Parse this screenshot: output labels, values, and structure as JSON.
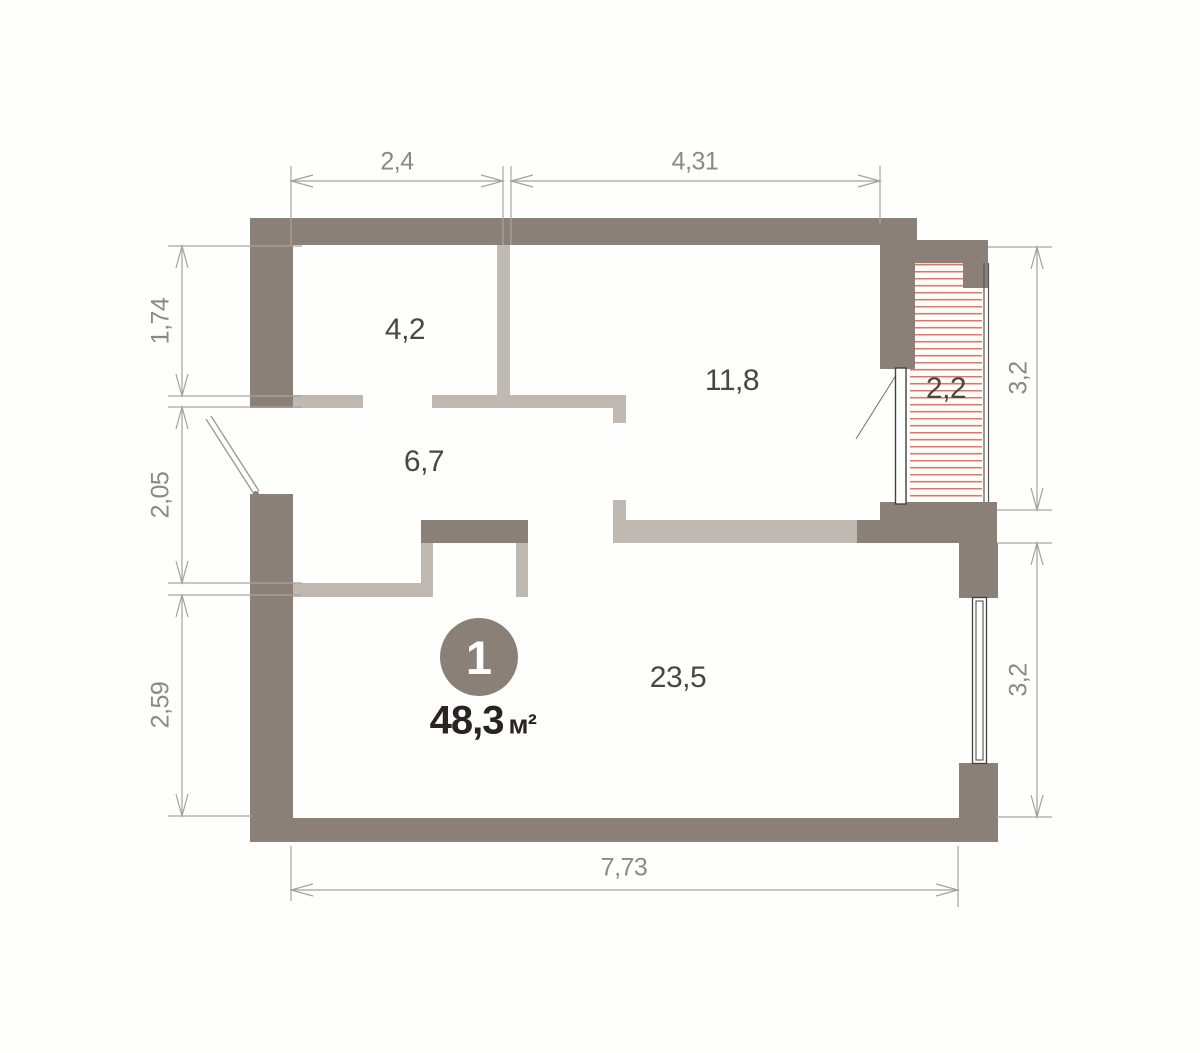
{
  "unit": {
    "number": "1",
    "area_value": "48,3",
    "area_unit": "м²"
  },
  "rooms": [
    {
      "area": "4,2"
    },
    {
      "area": "11,8"
    },
    {
      "area": "6,7"
    },
    {
      "area": "2,2"
    },
    {
      "area": "23,5"
    }
  ],
  "dimensions": {
    "top": [
      {
        "label": "2,4"
      },
      {
        "label": "4,31"
      }
    ],
    "left": [
      {
        "label": "1,74"
      },
      {
        "label": "2,05"
      },
      {
        "label": "2,59"
      }
    ],
    "right": [
      {
        "label": "3,2"
      },
      {
        "label": "3,2"
      }
    ],
    "bottom": [
      {
        "label": "7,73"
      }
    ]
  },
  "colors": {
    "wall_dark": "#8a8078",
    "wall_light": "#c0b9b2",
    "balcony_hatch_red": "#ee705e",
    "dimension_line": "#a8a19a",
    "dimension_text": "#8f8881",
    "room_text": "#4b4641",
    "area_text": "#292420",
    "badge_background": "#8a8078"
  }
}
